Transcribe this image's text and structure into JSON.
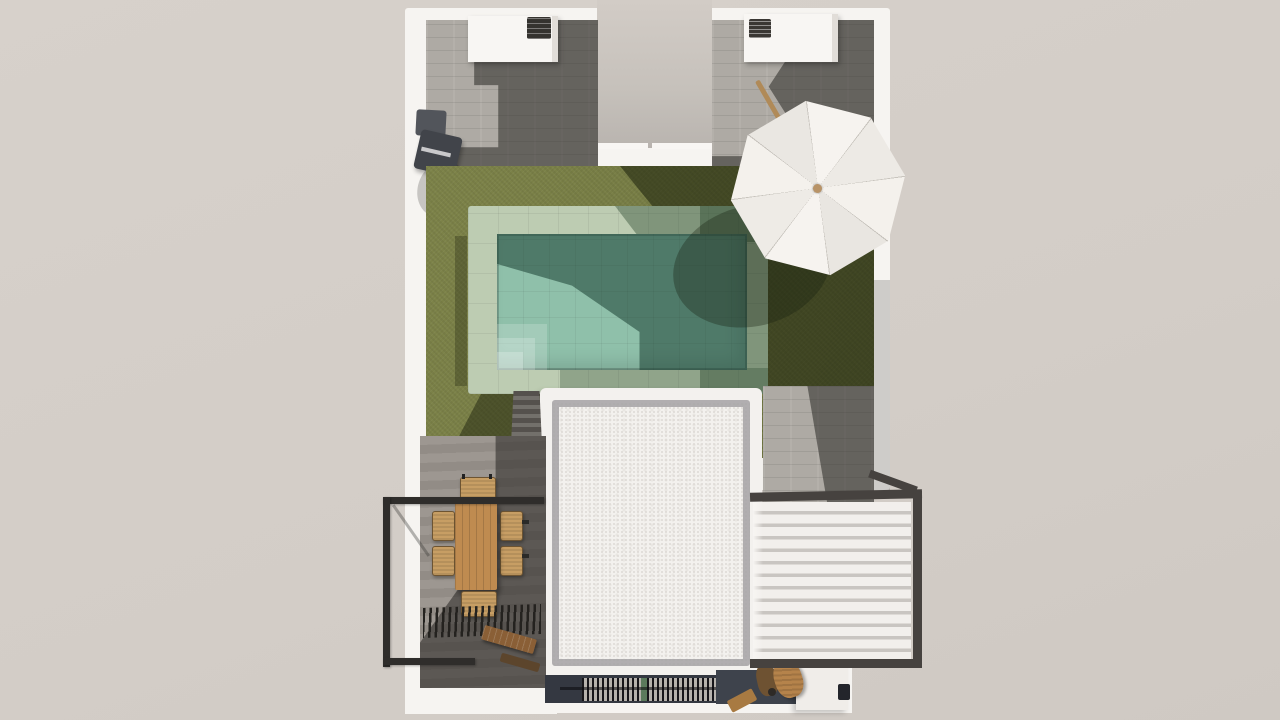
{
  "scene": {
    "title": "Villa terrace plan - 3D top-down rendering",
    "background": "#d5cfc8"
  },
  "labels": {
    "plot": "Villa plot with white perimeter walls",
    "notch": "Recessed entry lightwell",
    "patio_left": "Left outdoor kitchen patio",
    "patio_right": "Right outdoor kitchen patio",
    "counter_left": "Outdoor kitchen counter",
    "counter_right": "Outdoor kitchen counter",
    "grill_left": "Barbecue grill",
    "grill_right": "Barbecue grill",
    "fixture": "Wall-mounted outdoor fixture",
    "lawn": "Lawn",
    "pool": "Swimming pool",
    "pool_coping": "Pool stone coping",
    "pool_steps": "Pool entry steps",
    "tile_path": "Stone tile path",
    "roof": "Flat roof with gravel border",
    "stairs": "Stairs to dining deck",
    "deck": "Wood dining deck",
    "dining_table": "Outdoor dining table",
    "chair": "Dining chair",
    "railing": "Black metal balcony railing",
    "dark_louvers": "Slatted shade louvers",
    "bench": "Wooden bench",
    "pergola": "White louvered pergola",
    "grate": "Slatted vent grate",
    "green_slat": "Green slat detail",
    "step_block": "White step block",
    "wood_chairs": "Folded wooden chairs",
    "umbrella": "White patio umbrella",
    "umbrella_pole": "Tilted wooden umbrella pole"
  },
  "palette": {
    "background": "#d5cfc8",
    "wall_white": "#f6f4f1",
    "tile_grey": "#aeaaa4",
    "tile_shadow": "#4a4844",
    "grass_green": "#7d8349",
    "grass_shadow": "#3e431f",
    "pool_coping": "#bdccb2",
    "pool_water": "#8fc0aa",
    "pool_water_shadow": "#3f6b58",
    "roof_white": "#f3f1ee",
    "roof_gravel": "#a5a2a5",
    "deck_wood": "#9d9791",
    "railing_black": "#2f2d2b",
    "pergola_slat": "#f2efec",
    "furniture_wood": "#bf8b50",
    "umbrella_white": "#f4f1ed",
    "pole_tan": "#b08a58",
    "accent_green": "#5b7a5c"
  }
}
